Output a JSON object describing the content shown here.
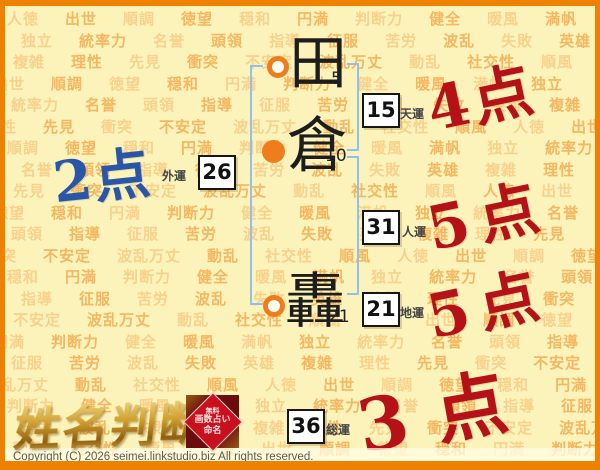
{
  "name": {
    "chars": [
      {
        "char": "田",
        "strokes": "5",
        "marker": "ring"
      },
      {
        "char": "倉",
        "strokes": "10",
        "marker": "dot"
      },
      {
        "char": "轟",
        "strokes": "21",
        "marker": "ring"
      }
    ]
  },
  "fortunes": {
    "ten": {
      "value": "15",
      "label": "天運",
      "score": "4点"
    },
    "gai": {
      "value": "26",
      "label": "外運",
      "score": "2点"
    },
    "jin": {
      "value": "31",
      "label": "人運",
      "score": "5点"
    },
    "chi": {
      "value": "21",
      "label": "地運",
      "score": "5点"
    },
    "sou": {
      "value": "36",
      "label": "総運",
      "score": "3点"
    }
  },
  "logo": {
    "title": "姓名判断",
    "seal_lines": [
      "無料",
      "画数占い",
      "命名"
    ]
  },
  "footer": {
    "copyright": "Copyright (C) 2026 seimei.linkstudio.biz All rights reserved."
  },
  "colors": {
    "accent_orange": "#ef8100",
    "score_red": "#b41217",
    "score_blue": "#2a56a8",
    "bracket_blue": "#8fc1f0",
    "page_background": "#fcf3bb",
    "watermark_light": "#f8d18c",
    "watermark_dark": "#f5b761"
  },
  "background": {
    "words": [
      "人徳",
      "出世",
      "順調",
      "徳望",
      "穏和",
      "円満",
      "判断力",
      "健全",
      "暖風",
      "満帆",
      "独立",
      "統率力",
      "名誉",
      "頭領",
      "指導",
      "征服",
      "苦労",
      "波乱",
      "失敗",
      "英雄",
      "複雑",
      "理性",
      "先見",
      "衝突",
      "不安定",
      "波乱万丈",
      "動乱",
      "社交性",
      "順風"
    ]
  }
}
